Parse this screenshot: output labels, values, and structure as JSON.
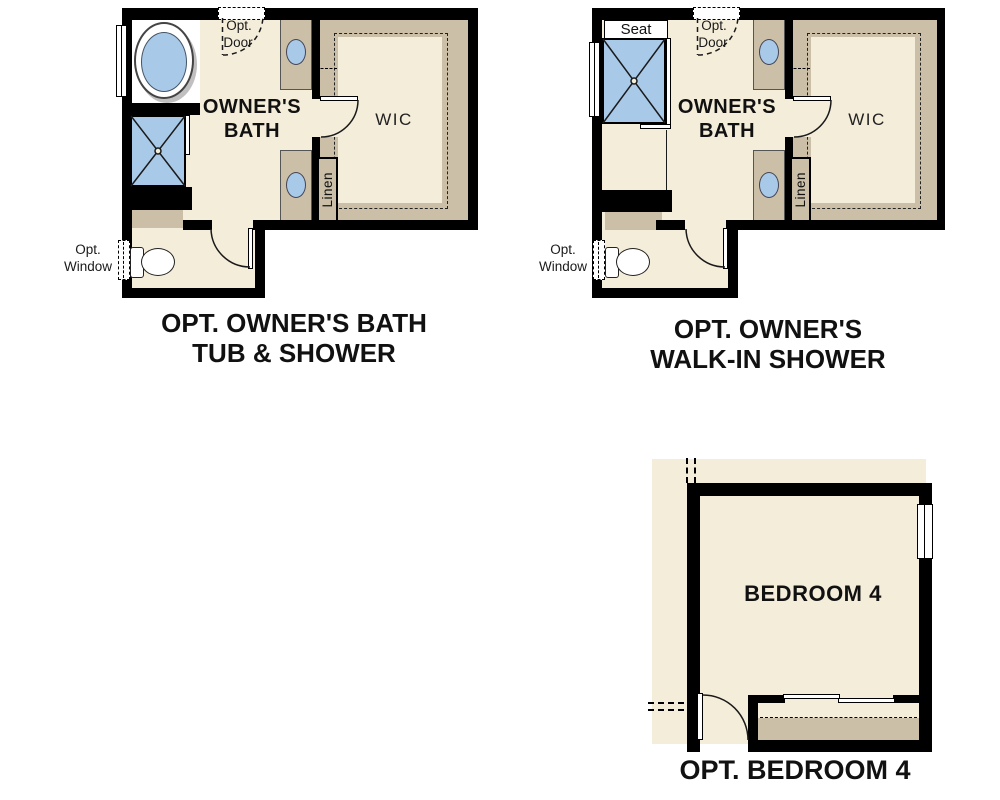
{
  "plan_tub_shower": {
    "caption_1": "OPT. OWNER'S BATH",
    "caption_2": "TUB & SHOWER",
    "room_1": "OWNER'S",
    "room_2": "BATH",
    "wic": "WIC",
    "linen": "Linen",
    "opt_door_1": "Opt.",
    "opt_door_2": "Door",
    "opt_window_1": "Opt.",
    "opt_window_2": "Window"
  },
  "plan_walkin_shower": {
    "caption_1": "OPT. OWNER'S",
    "caption_2": "WALK-IN SHOWER",
    "room_1": "OWNER'S",
    "room_2": "BATH",
    "wic": "WIC",
    "linen": "Linen",
    "seat": "Seat",
    "opt_door_1": "Opt.",
    "opt_door_2": "Door",
    "opt_window_1": "Opt.",
    "opt_window_2": "Window"
  },
  "plan_bedroom4": {
    "room": "BEDROOM 4",
    "caption": "OPT. BEDROOM 4"
  },
  "colors": {
    "wall": "#000000",
    "floor": "#f4edda",
    "cabinet": "#cbc0a7",
    "fixture_blue": "#a9c9e9",
    "line": "#1a1a1a",
    "background": "#ffffff"
  }
}
